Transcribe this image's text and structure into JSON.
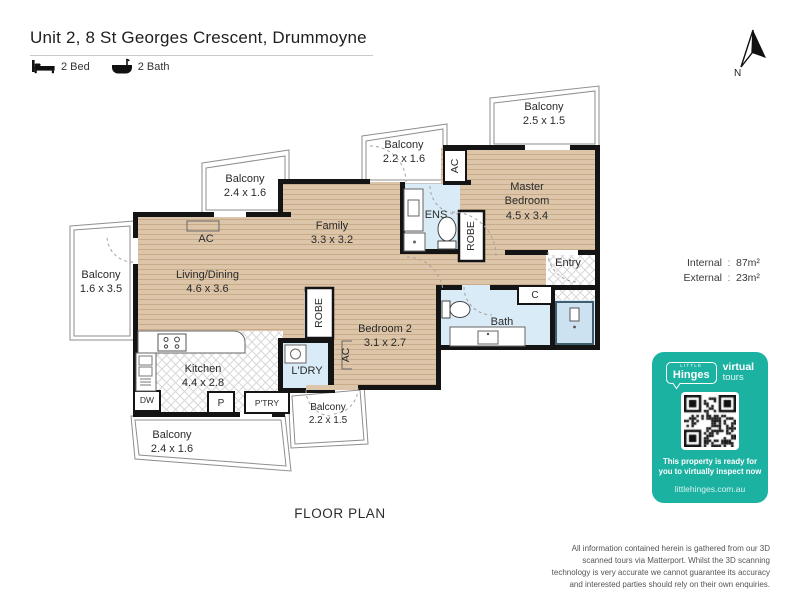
{
  "header": {
    "title": "Unit 2, 8 St Georges Crescent, Drummoyne",
    "beds": "2 Bed",
    "baths": "2 Bath"
  },
  "compass": {
    "label": "N"
  },
  "areas": {
    "internal_label": "Internal",
    "internal_value": "87m²",
    "external_label": "External",
    "external_value": "23m²",
    "sep": ":"
  },
  "plan": {
    "caption": "FLOOR PLAN",
    "rooms": {
      "balcony_tr": {
        "name": "Balcony",
        "dims": "2.5 x 1.5"
      },
      "balcony_tm": {
        "name": "Balcony",
        "dims": "2.2 x 1.6"
      },
      "balcony_tl": {
        "name": "Balcony",
        "dims": "2.4 x 1.6"
      },
      "balcony_left": {
        "name": "Balcony",
        "dims": "1.6 x 3.5"
      },
      "balcony_bl": {
        "name": "Balcony",
        "dims": "2.4 x 1.6"
      },
      "balcony_bm": {
        "name": "Balcony",
        "dims": "2.2 x 1.5"
      },
      "master": {
        "name": "Master Bedroom",
        "dims": "4.5 x 3.4"
      },
      "family": {
        "name": "Family",
        "dims": "3.3 x 3.2"
      },
      "living": {
        "name": "Living/Dining",
        "dims": "4.6 x 3.6"
      },
      "bedroom2": {
        "name": "Bedroom 2",
        "dims": "3.1 x 2.7"
      },
      "kitchen": {
        "name": "Kitchen",
        "dims": "4.4 x 2.8"
      },
      "ens": {
        "name": "ENS"
      },
      "bath": {
        "name": "Bath"
      },
      "entry": {
        "name": "Entry"
      },
      "ldry": {
        "name": "L'DRY"
      },
      "robe_master": {
        "name": "ROBE"
      },
      "robe_bed2": {
        "name": "ROBE"
      },
      "ac_top": {
        "name": "AC"
      },
      "ac_living": {
        "name": "AC"
      },
      "ac_bed2": {
        "name": "AC"
      },
      "closet": {
        "name": "C"
      },
      "dw": {
        "name": "DW"
      },
      "p": {
        "name": "P"
      },
      "ptry": {
        "name": "P'TRY"
      }
    }
  },
  "badge": {
    "brand_small": "LITTLE",
    "brand_name": "Hinges",
    "brand_bold": "virtual",
    "brand_reg": "tours",
    "message_line1": "This property is ready for",
    "message_line2": "you to virtually inspect now",
    "url": "littlehinges.com.au"
  },
  "disclaimer": "All information contained herein is gathered from our 3D scanned tours via Matterport. Whilst the 3D scanning technology is very accurate we cannot guarantee its accuracy and interested parties should rely on their own enquiries.",
  "colors": {
    "badge_teal": "#1cb2a2",
    "floor_wood": "#dcc5a9",
    "tile_blue": "#d9ebf7",
    "wall_black": "#141414"
  }
}
